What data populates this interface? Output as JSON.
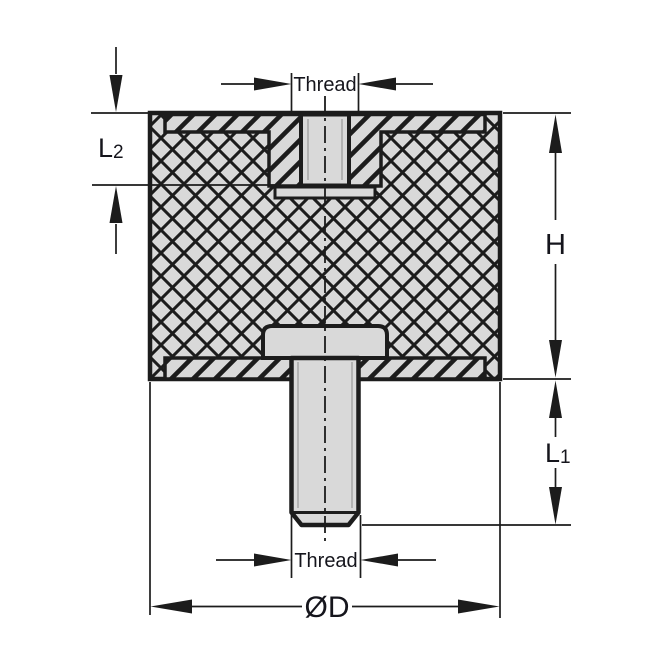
{
  "drawing": {
    "labels": {
      "thread_top": "Thread",
      "thread_bottom": "Thread",
      "height": "H",
      "stud_length_main": "L",
      "stud_length_sub": "1",
      "insert_depth_main": "L",
      "insert_depth_sub": "2",
      "diameter": "ØD"
    },
    "colors": {
      "line": "#1c1c1c",
      "part_fill": "#d9d9d9",
      "thread_relief": "#a8a8a8",
      "text": "#15151c",
      "background": "#ffffff"
    }
  }
}
